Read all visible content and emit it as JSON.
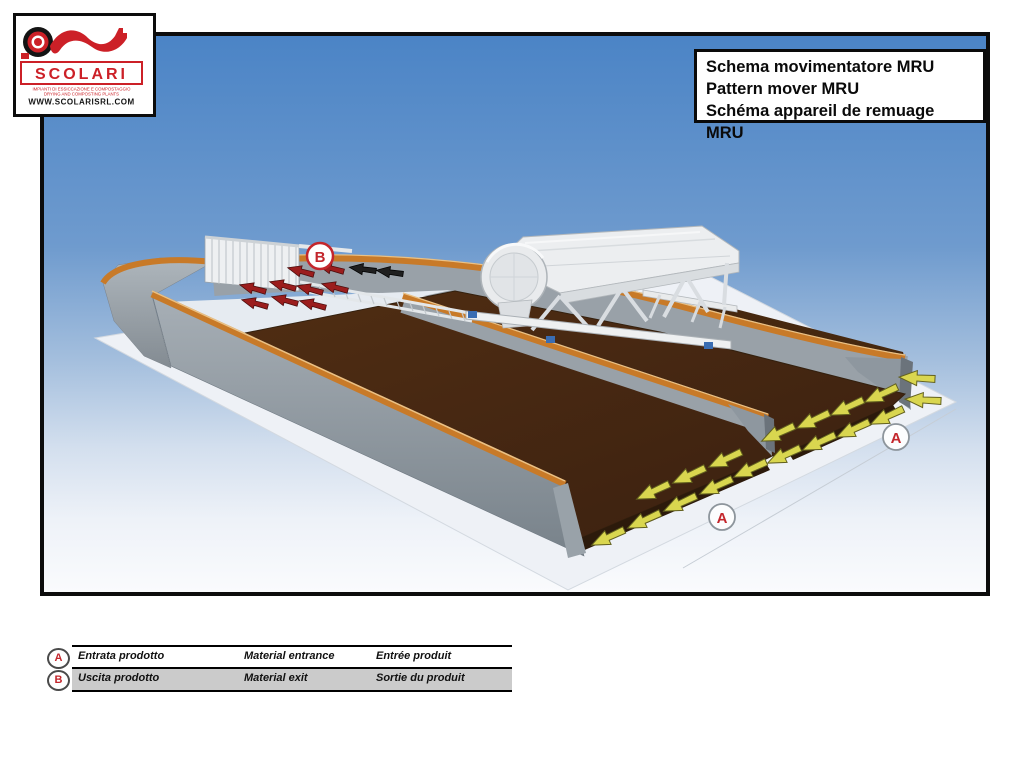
{
  "colors": {
    "accent_red": "#c3262c",
    "rail_orange": "#c87a28",
    "bed_brown": "#45270f",
    "wall_gray": "#99a1a8",
    "arrow_yellow": "#d9d64f",
    "arrow_dark_red": "#9b1d1d",
    "sky_blue": "#4b84c6",
    "legend_row_gray": "#cbcbcb"
  },
  "logo": {
    "name": "SCOLARI",
    "tagline_line1": "IMPIANTI DI ESSICCAZIONE E COMPOSTAGGIO",
    "tagline_line2": "DRYING AND COMPOSTING PLANTS",
    "website": "WWW.SCOLARISRL.COM"
  },
  "title_box": {
    "line_it": "Schema movimentatore MRU",
    "line_en": "Pattern mover MRU",
    "line_fr": "Schéma appareil de remuage MRU"
  },
  "diagram": {
    "marker_entrance": "A",
    "marker_exit": "B"
  },
  "legend": {
    "rows": [
      {
        "marker": "A",
        "it": "Entrata prodotto",
        "en": "Material entrance",
        "fr": "Entrée produit"
      },
      {
        "marker": "B",
        "it": "Uscita prodotto",
        "en": "Material exit",
        "fr": "Sortie du produit"
      }
    ]
  }
}
